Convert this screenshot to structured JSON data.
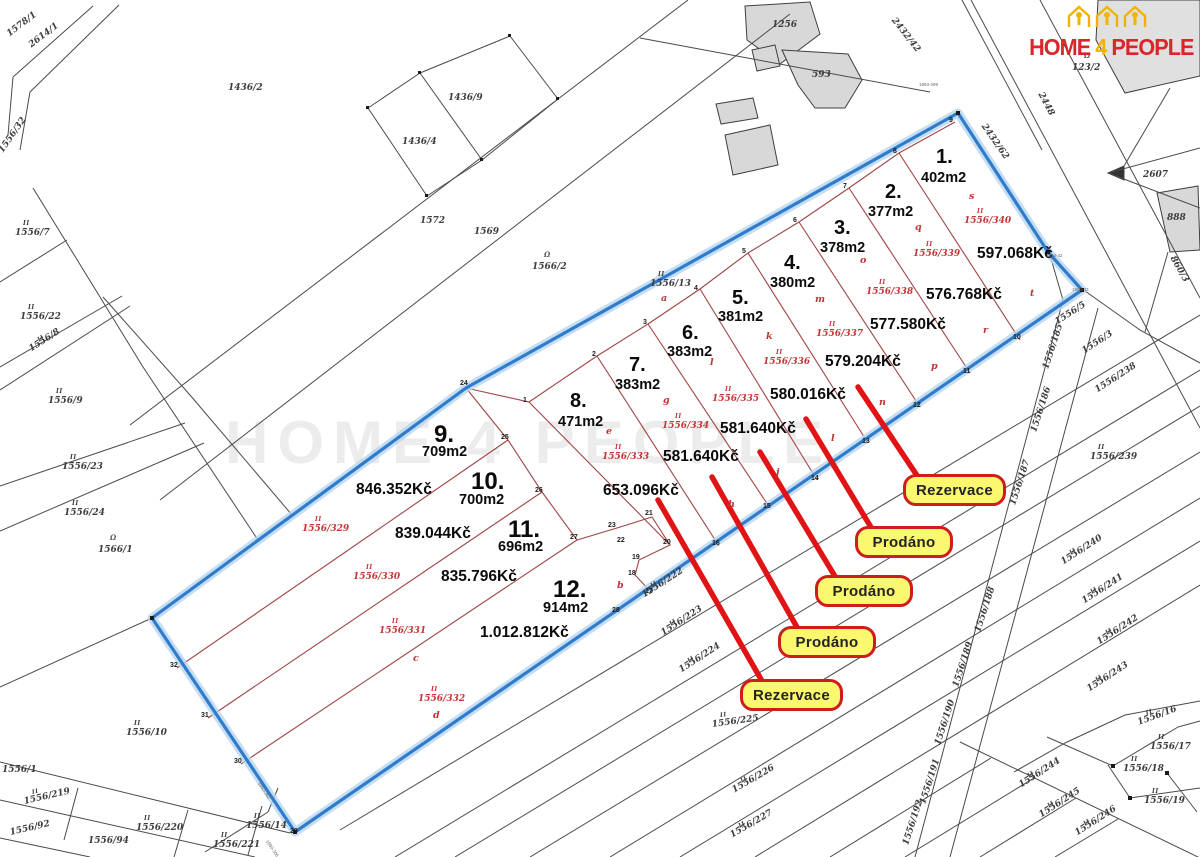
{
  "logo": {
    "word1": "HOME",
    "word2": "4",
    "word3": "PEOPLE",
    "red": "#d8262b",
    "yellow": "#f0b400",
    "icon": "houses-with-people"
  },
  "watermark": "HOME 4 PEOPLE",
  "colors": {
    "boundary_blue": "#2e7ccc",
    "plot_line_red": "#a04444",
    "leader_red": "#e01414",
    "badge_yellow": "#faf86e",
    "badge_border": "#cf1d1d",
    "cadastre_line": "#4a4a4a",
    "building_gray": "#d8d8d8"
  },
  "plots": [
    {
      "number": "1.",
      "area": "402m2",
      "price": "597.068Kč",
      "parcel": "1556/340",
      "np": [
        936,
        146
      ],
      "ap": [
        921,
        170
      ],
      "pp": [
        977,
        245
      ],
      "cp": [
        964,
        216
      ],
      "ip": [
        977,
        208
      ]
    },
    {
      "number": "2.",
      "area": "377m2",
      "price": "576.768Kč",
      "parcel": "1556/339",
      "np": [
        885,
        181
      ],
      "ap": [
        868,
        204
      ],
      "pp": [
        926,
        286
      ],
      "cp": [
        913,
        249
      ],
      "ip": [
        926,
        241
      ]
    },
    {
      "number": "3.",
      "area": "378m2",
      "price": "577.580Kč",
      "parcel": "1556/338",
      "np": [
        834,
        217
      ],
      "ap": [
        820,
        240
      ],
      "pp": [
        870,
        316
      ],
      "cp": [
        866,
        287
      ],
      "ip": [
        879,
        279
      ]
    },
    {
      "number": "4.",
      "area": "380m2",
      "price": "579.204Kč",
      "parcel": "1556/337",
      "status": "Rezervace",
      "np": [
        784,
        252
      ],
      "ap": [
        770,
        275
      ],
      "pp": [
        825,
        353
      ],
      "cp": [
        816,
        329
      ],
      "ip": [
        829,
        321
      ]
    },
    {
      "number": "5.",
      "area": "381m2",
      "price": "580.016Kč",
      "parcel": "1556/336",
      "status": "Prodáno",
      "np": [
        732,
        287
      ],
      "ap": [
        718,
        309
      ],
      "pp": [
        770,
        386
      ],
      "cp": [
        763,
        357
      ],
      "ip": [
        776,
        349
      ]
    },
    {
      "number": "6.",
      "area": "383m2",
      "price": "581.640Kč",
      "parcel": "1556/335",
      "status": "Prodáno",
      "np": [
        682,
        322
      ],
      "ap": [
        667,
        344
      ],
      "pp": [
        720,
        420
      ],
      "cp": [
        712,
        394
      ],
      "ip": [
        725,
        386
      ]
    },
    {
      "number": "7.",
      "area": "383m2",
      "price": "581.640Kč",
      "parcel": "1556/334",
      "status": "Prodáno",
      "np": [
        629,
        354
      ],
      "ap": [
        615,
        377
      ],
      "pp": [
        663,
        448
      ],
      "cp": [
        662,
        421
      ],
      "ip": [
        675,
        413
      ]
    },
    {
      "number": "8.",
      "area": "471m2",
      "price": "653.096Kč",
      "parcel": "1556/333",
      "status": "Rezervace",
      "np": [
        570,
        390
      ],
      "ap": [
        558,
        414
      ],
      "pp": [
        603,
        482
      ],
      "cp": [
        602,
        452
      ],
      "ip": [
        615,
        444
      ]
    },
    {
      "number": "9.",
      "area": "709m2",
      "price": "846.352Kč",
      "parcel": "1556/329",
      "np": [
        434,
        421
      ],
      "ap": [
        422,
        444
      ],
      "pp": [
        356,
        481
      ],
      "cp": [
        302,
        524
      ],
      "ip": [
        315,
        516
      ]
    },
    {
      "number": "10.",
      "area": "700m2",
      "price": "839.044Kč",
      "parcel": "1556/330",
      "np": [
        471,
        468
      ],
      "ap": [
        459,
        492
      ],
      "pp": [
        395,
        525
      ],
      "cp": [
        353,
        572
      ],
      "ip": [
        366,
        564
      ]
    },
    {
      "number": "11.",
      "area": "696m2",
      "price": "835.796Kč",
      "parcel": "1556/331",
      "np": [
        508,
        516
      ],
      "ap": [
        498,
        539
      ],
      "pp": [
        441,
        568
      ],
      "cp": [
        379,
        626
      ],
      "ip": [
        392,
        618
      ]
    },
    {
      "number": "12.",
      "area": "914m2",
      "price": "1.012.812Kč",
      "parcel": "1556/332",
      "np": [
        553,
        576
      ],
      "ap": [
        543,
        600
      ],
      "pp": [
        480,
        624
      ],
      "cp": [
        418,
        694
      ],
      "ip": [
        431,
        686
      ]
    }
  ],
  "statuses": [
    {
      "label": "Rezervace",
      "x": 903,
      "y": 474,
      "w": 97,
      "points_to_plot": "4."
    },
    {
      "label": "Prodáno",
      "x": 855,
      "y": 526,
      "w": 92,
      "points_to_plot": "5."
    },
    {
      "label": "Prodáno",
      "x": 815,
      "y": 575,
      "w": 92,
      "points_to_plot": "6."
    },
    {
      "label": "Prodáno",
      "x": 778,
      "y": 626,
      "w": 92,
      "points_to_plot": "7."
    },
    {
      "label": "Rezervace",
      "x": 740,
      "y": 679,
      "w": 97,
      "points_to_plot": "8."
    }
  ],
  "neighbor_labels": [
    {
      "t": "1578/1",
      "x": 8,
      "y": 30,
      "r": -37
    },
    {
      "t": "2614/1",
      "x": 30,
      "y": 41,
      "r": -37
    },
    {
      "t": "1556/32",
      "x": 1,
      "y": 147,
      "r": -55
    },
    {
      "t": "1436/2",
      "x": 228,
      "y": 83
    },
    {
      "t": "1436/9",
      "x": 448,
      "y": 93
    },
    {
      "t": "1436/4",
      "x": 402,
      "y": 137
    },
    {
      "t": "1572",
      "x": 420,
      "y": 216
    },
    {
      "t": "1569",
      "x": 474,
      "y": 227
    },
    {
      "t": "1566/2",
      "x": 532,
      "y": 262,
      "sym": 1
    },
    {
      "t": "1556/13",
      "x": 650,
      "y": 279,
      "ii": 1
    },
    {
      "t": "1256",
      "x": 772,
      "y": 20
    },
    {
      "t": "593",
      "x": 812,
      "y": 70
    },
    {
      "t": "2432/42",
      "x": 893,
      "y": 14,
      "r": 52
    },
    {
      "t": "2432/62",
      "x": 983,
      "y": 120,
      "r": 55
    },
    {
      "t": "2448",
      "x": 1040,
      "y": 88,
      "r": 62
    },
    {
      "t": "123/2",
      "x": 1072,
      "y": 63,
      "sym": 1
    },
    {
      "t": "2607",
      "x": 1143,
      "y": 170
    },
    {
      "t": "888",
      "x": 1167,
      "y": 213
    },
    {
      "t": "860/3",
      "x": 1172,
      "y": 252,
      "r": 60
    },
    {
      "t": "1556/5",
      "x": 1056,
      "y": 318,
      "r": -33
    },
    {
      "t": "1556/3",
      "x": 1083,
      "y": 347,
      "r": -33
    },
    {
      "t": "1556/7",
      "x": 15,
      "y": 228,
      "ii": 1
    },
    {
      "t": "1556/22",
      "x": 20,
      "y": 312,
      "ii": 1
    },
    {
      "t": "1556/8",
      "x": 30,
      "y": 345,
      "r": -33,
      "ii": 1
    },
    {
      "t": "1556/9",
      "x": 48,
      "y": 396,
      "ii": 1
    },
    {
      "t": "1556/23",
      "x": 62,
      "y": 462,
      "ii": 1
    },
    {
      "t": "1556/24",
      "x": 64,
      "y": 508,
      "ii": 1
    },
    {
      "t": "1566/1",
      "x": 98,
      "y": 545,
      "sym": 1
    },
    {
      "t": "1556/10",
      "x": 126,
      "y": 728,
      "ii": 1
    },
    {
      "t": "1556/1",
      "x": 2,
      "y": 765
    },
    {
      "t": "1556/219",
      "x": 24,
      "y": 797,
      "r": -13,
      "ii": 1
    },
    {
      "t": "1556/92",
      "x": 10,
      "y": 828,
      "r": -13
    },
    {
      "t": "1556/94",
      "x": 88,
      "y": 836
    },
    {
      "t": "1556/220",
      "x": 136,
      "y": 823,
      "ii": 1
    },
    {
      "t": "1556/221",
      "x": 213,
      "y": 840,
      "ii": 1
    },
    {
      "t": "1556/14",
      "x": 246,
      "y": 821,
      "ii": 1
    },
    {
      "t": "1556/222",
      "x": 643,
      "y": 591,
      "r": -33,
      "ii": 1
    },
    {
      "t": "1556/223",
      "x": 662,
      "y": 629,
      "r": -33,
      "ii": 1
    },
    {
      "t": "1556/224",
      "x": 680,
      "y": 666,
      "r": -33,
      "ii": 1
    },
    {
      "t": "1556/225",
      "x": 712,
      "y": 720,
      "r": -8,
      "ii": 1
    },
    {
      "t": "1556/226",
      "x": 733,
      "y": 786,
      "r": -30,
      "ii": 1
    },
    {
      "t": "1556/227",
      "x": 731,
      "y": 831,
      "r": -30,
      "ii": 1
    },
    {
      "t": "1556/185",
      "x": 1046,
      "y": 364,
      "r": -72
    },
    {
      "t": "1556/186",
      "x": 1034,
      "y": 427,
      "r": -72
    },
    {
      "t": "1556/187",
      "x": 1013,
      "y": 500,
      "r": -72
    },
    {
      "t": "1556/188",
      "x": 978,
      "y": 627,
      "r": -72
    },
    {
      "t": "1556/189",
      "x": 956,
      "y": 682,
      "r": -72
    },
    {
      "t": "1556/190",
      "x": 938,
      "y": 740,
      "r": -72
    },
    {
      "t": "1556/191",
      "x": 923,
      "y": 799,
      "r": -72
    },
    {
      "t": "1556/192",
      "x": 906,
      "y": 840,
      "r": -72
    },
    {
      "t": "1556/238",
      "x": 1096,
      "y": 386,
      "r": -33
    },
    {
      "t": "1556/239",
      "x": 1090,
      "y": 452,
      "ii": 1
    },
    {
      "t": "1556/240",
      "x": 1062,
      "y": 558,
      "r": -33,
      "ii": 1
    },
    {
      "t": "1556/241",
      "x": 1083,
      "y": 597,
      "r": -33,
      "ii": 1
    },
    {
      "t": "1556/242",
      "x": 1098,
      "y": 638,
      "r": -33,
      "ii": 1
    },
    {
      "t": "1556/243",
      "x": 1088,
      "y": 685,
      "r": -33,
      "ii": 1
    },
    {
      "t": "1556/244",
      "x": 1020,
      "y": 781,
      "r": -33,
      "ii": 1
    },
    {
      "t": "1556/245",
      "x": 1040,
      "y": 811,
      "r": -33,
      "ii": 1
    },
    {
      "t": "1556/246",
      "x": 1076,
      "y": 829,
      "r": -33,
      "ii": 1
    },
    {
      "t": "1556/16",
      "x": 1138,
      "y": 718,
      "r": -20,
      "ii": 1
    },
    {
      "t": "1556/17",
      "x": 1150,
      "y": 742,
      "ii": 1
    },
    {
      "t": "1556/18",
      "x": 1123,
      "y": 764,
      "ii": 1
    },
    {
      "t": "1556/19",
      "x": 1144,
      "y": 796,
      "ii": 1
    }
  ],
  "vertex_numbers": [
    {
      "t": "1",
      "x": 523,
      "y": 397
    },
    {
      "t": "2",
      "x": 592,
      "y": 351
    },
    {
      "t": "3",
      "x": 643,
      "y": 319
    },
    {
      "t": "4",
      "x": 694,
      "y": 285
    },
    {
      "t": "5",
      "x": 742,
      "y": 248
    },
    {
      "t": "6",
      "x": 793,
      "y": 217
    },
    {
      "t": "7",
      "x": 843,
      "y": 183
    },
    {
      "t": "8",
      "x": 893,
      "y": 148
    },
    {
      "t": "9",
      "x": 949,
      "y": 117
    },
    {
      "t": "10",
      "x": 1013,
      "y": 334
    },
    {
      "t": "11",
      "x": 963,
      "y": 368
    },
    {
      "t": "12",
      "x": 913,
      "y": 402
    },
    {
      "t": "13",
      "x": 862,
      "y": 438
    },
    {
      "t": "14",
      "x": 811,
      "y": 475
    },
    {
      "t": "15",
      "x": 763,
      "y": 503
    },
    {
      "t": "16",
      "x": 712,
      "y": 540
    },
    {
      "t": "17",
      "x": 645,
      "y": 588
    },
    {
      "t": "18",
      "x": 628,
      "y": 570
    },
    {
      "t": "19",
      "x": 632,
      "y": 554
    },
    {
      "t": "20",
      "x": 663,
      "y": 539
    },
    {
      "t": "21",
      "x": 645,
      "y": 510
    },
    {
      "t": "22",
      "x": 617,
      "y": 537
    },
    {
      "t": "23",
      "x": 608,
      "y": 522
    },
    {
      "t": "24",
      "x": 460,
      "y": 380
    },
    {
      "t": "25",
      "x": 501,
      "y": 434
    },
    {
      "t": "26",
      "x": 535,
      "y": 487
    },
    {
      "t": "27",
      "x": 570,
      "y": 534
    },
    {
      "t": "28",
      "x": 612,
      "y": 607
    },
    {
      "t": "29",
      "x": 290,
      "y": 828
    },
    {
      "t": "30",
      "x": 234,
      "y": 758
    },
    {
      "t": "31",
      "x": 201,
      "y": 712
    },
    {
      "t": "32",
      "x": 170,
      "y": 662
    }
  ],
  "red_letters": [
    {
      "t": "s",
      "x": 969,
      "y": 191
    },
    {
      "t": "q",
      "x": 915,
      "y": 222
    },
    {
      "t": "o",
      "x": 860,
      "y": 255
    },
    {
      "t": "m",
      "x": 815,
      "y": 294
    },
    {
      "t": "k",
      "x": 766,
      "y": 331
    },
    {
      "t": "l",
      "x": 710,
      "y": 357
    },
    {
      "t": "g",
      "x": 663,
      "y": 395
    },
    {
      "t": "e",
      "x": 606,
      "y": 426
    },
    {
      "t": "a",
      "x": 661,
      "y": 293
    },
    {
      "t": "b",
      "x": 617,
      "y": 580
    },
    {
      "t": "c",
      "x": 413,
      "y": 653
    },
    {
      "t": "d",
      "x": 433,
      "y": 710
    },
    {
      "t": "h",
      "x": 728,
      "y": 499
    },
    {
      "t": "j",
      "x": 776,
      "y": 467
    },
    {
      "t": "l",
      "x": 831,
      "y": 433
    },
    {
      "t": "n",
      "x": 879,
      "y": 397
    },
    {
      "t": "p",
      "x": 931,
      "y": 361
    },
    {
      "t": "r",
      "x": 983,
      "y": 325
    },
    {
      "t": "t",
      "x": 1030,
      "y": 288
    }
  ],
  "survey_marks": [
    {
      "t": "1993-299",
      "x": 919,
      "y": 82,
      "r": 0
    },
    {
      "t": "1994-42",
      "x": 1046,
      "y": 253,
      "r": 0
    },
    {
      "t": "1994-43",
      "x": 1072,
      "y": 287,
      "r": 0
    },
    {
      "t": "1992-382",
      "x": 259,
      "y": 780,
      "r": 56
    },
    {
      "t": "1990-306",
      "x": 267,
      "y": 838,
      "r": 56
    }
  ],
  "symbol_glyph": "Ω",
  "ii_glyph": "II"
}
